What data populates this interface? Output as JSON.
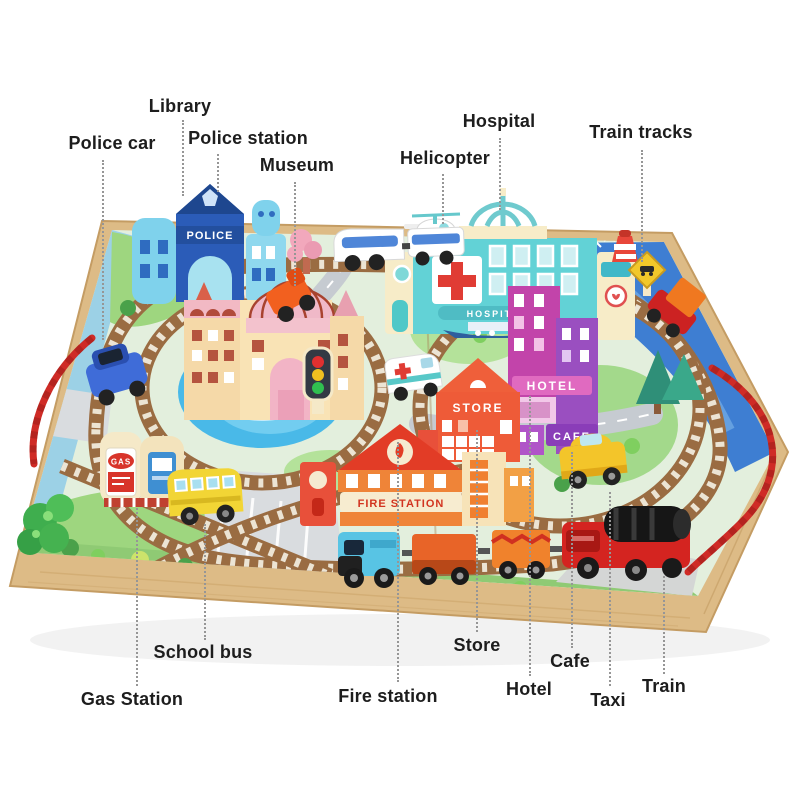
{
  "annotations": [
    {
      "id": "library",
      "label": "Library"
    },
    {
      "id": "police-car",
      "label": "Police car"
    },
    {
      "id": "police-station",
      "label": "Police station"
    },
    {
      "id": "museum",
      "label": "Museum"
    },
    {
      "id": "hospital",
      "label": "Hospital"
    },
    {
      "id": "helicopter",
      "label": "Helicopter"
    },
    {
      "id": "train-tracks",
      "label": "Train tracks"
    },
    {
      "id": "school-bus",
      "label": "School bus"
    },
    {
      "id": "gas-station",
      "label": "Gas Station"
    },
    {
      "id": "fire-station",
      "label": "Fire station"
    },
    {
      "id": "store",
      "label": "Store"
    },
    {
      "id": "hotel",
      "label": "Hotel"
    },
    {
      "id": "cafe",
      "label": "Cafe"
    },
    {
      "id": "taxi",
      "label": "Taxi"
    },
    {
      "id": "train",
      "label": "Train"
    }
  ],
  "board_signs": {
    "police": "POLICE",
    "hospital": "HOSPITAL",
    "store": "STORE",
    "hotel": "HOTEL",
    "cafe": "CAFE",
    "fire_station": "FIRE STATION",
    "gas": "GAS"
  },
  "colors": {
    "label_text": "#1d1d1d",
    "leader_line": "#969696",
    "board_wood": "#ddbb86",
    "water": "#3e7ed2",
    "grass": "#a3d98b",
    "track_bed": "#9a6c42",
    "rope": "#cf2b26"
  }
}
